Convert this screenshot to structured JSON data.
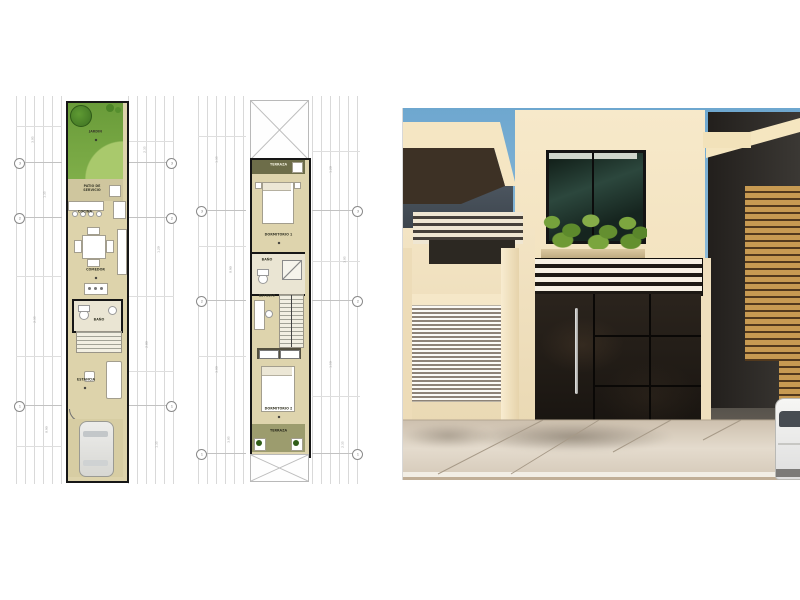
{
  "plans": {
    "dims": [
      "3.05",
      "1.35",
      "2.35",
      "0.90",
      "1.20",
      "2.80",
      "3.00",
      "1.50"
    ],
    "bubbles": [
      "3",
      "2",
      "1"
    ],
    "ground": {
      "jardin": "JARDIN",
      "patio": "PATIO DE SERVICIO",
      "cocina": "COCINA",
      "comedor": "COMEDOR",
      "bano": "BAÑO",
      "estancia": "ESTANCIA"
    },
    "upper": {
      "terraza_top": "TERRAZA",
      "dorm1": "DORMITORIO 1",
      "bano": "BAÑO",
      "estudio": "ESTUDIO",
      "dorm2": "DORMITORIO 2",
      "terraza_bottom": "TERRAZA"
    }
  },
  "render": {
    "colors": {
      "sky": "#7fb0d4",
      "wall_cream": "#f2e2c4",
      "gate_dark": "#241e18",
      "wood": "#c79a55",
      "window_glass": "#1e3329",
      "plants": "#6f9a35",
      "sidewalk": "#d5c9ba"
    }
  }
}
